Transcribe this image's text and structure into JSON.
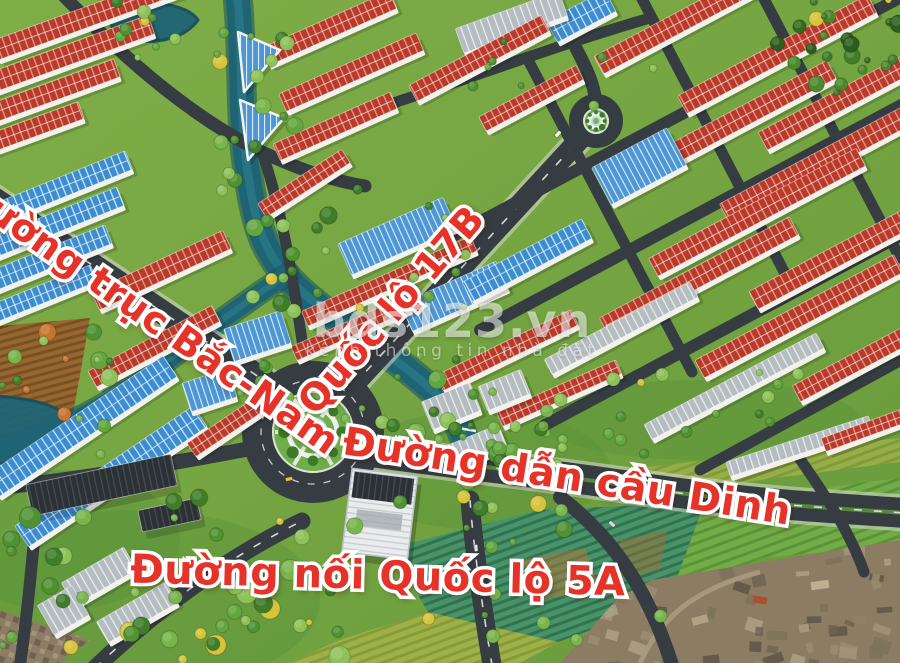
{
  "watermark": {
    "brand": "bds123.vn",
    "tagline": "kênh thông tin nhà đất"
  },
  "labels": [
    {
      "id": "bac-nam",
      "text": "Đường trục Bắc-Nam"
    },
    {
      "id": "quoc-lo-17b",
      "text": "Quốc lộ 17B"
    },
    {
      "id": "dan-cau-dinh",
      "text": "Đường dẫn cầu Dinh"
    },
    {
      "id": "noi-quoc-lo-5a",
      "text": "Đường nối Quốc lộ 5A"
    }
  ],
  "palette": {
    "label_red": "#e6332a",
    "label_outline": "#ffffff",
    "road": "#363d42",
    "red_roof": "#b93a2a",
    "blue_roof": "#3d8cd0",
    "water": "#1f6475",
    "grass": "#76a33f"
  },
  "scene": {
    "fields": [
      {
        "pts": "0,326 90,318 72,420 0,446",
        "fill": "url(#pBrown)",
        "o": 1
      },
      {
        "pts": "390,548 540,510 705,502 668,602 558,642 428,612",
        "fill": "url(#pFieldT)",
        "o": 1
      },
      {
        "pts": "705,502 900,478 900,545 762,558 668,602",
        "fill": "url(#pFieldG)",
        "o": 1
      },
      {
        "pts": "428,612 558,642 520,663 288,663 340,640",
        "fill": "url(#pFieldY)",
        "o": 0.9
      },
      {
        "pts": "640,468 900,438 900,462 652,494",
        "fill": "url(#pFieldY)",
        "o": 0.75
      },
      {
        "pts": "520,560 585,548 600,590 540,600",
        "fill": "#b5763a",
        "o": 0.5
      },
      {
        "pts": "620,540 668,530 660,570 618,578",
        "fill": "#a86c34",
        "o": 0.45
      },
      {
        "pts": "0,610 90,640 60,663 0,663",
        "fill": "url(#pPhotoM)",
        "o": 1
      }
    ],
    "photo": {
      "poly": "560,663 618,598 652,580 762,562 900,540 900,663"
    },
    "river": {
      "main": "M 237 -8 C 244 55 238 115 249 180 C 256 228 266 254 290 280 C 328 320 392 352 434 392 C 450 407 458 420 464 438",
      "fork": "M 288 274 C 248 300 208 330 168 360 C 130 390 96 412 56 428 C 36 436 12 446 -8 450",
      "wMain": 24,
      "wFork": 18
    },
    "ponds": [
      "M 112 -6 C 150 4 186 2 198 20 C 184 40 150 46 126 38 C 108 32 104 10 112 -6 Z",
      "M -5 396 C 30 398 62 404 80 428 C 64 452 30 460 -5 464 Z"
    ],
    "roads": [
      {
        "d": "M -15 193 L 296 402",
        "w": 24,
        "cas": 1,
        "dash": 1
      },
      {
        "d": "M 312 430 L 592 126",
        "w": 21,
        "cas": 1,
        "dash": 1
      },
      {
        "d": "M 596 118 C 600 72 566 44 552 -8",
        "w": 13,
        "cas": 0,
        "dash": 0
      },
      {
        "d": "M 318 444 C 430 462 540 472 650 489 C 770 506 835 508 905 513",
        "w": 30,
        "cas": 1,
        "dash": 1,
        "med": 1
      },
      {
        "d": "M 470 500 C 473 542 480 592 492 665",
        "w": 19,
        "cas": 0,
        "dash": 1
      },
      {
        "d": "M 560 497 C 606 532 646 582 672 665",
        "w": 14,
        "cas": 0,
        "dash": 0
      },
      {
        "d": "M 795 452 C 826 496 850 532 864 572",
        "w": 11,
        "cas": 0,
        "dash": 0
      },
      {
        "d": "M 258 447 C 180 462 90 478 -5 488",
        "w": 15,
        "cas": 0,
        "dash": 0
      },
      {
        "d": "M 95 668 C 152 614 222 560 302 521",
        "w": 17,
        "cas": 0,
        "dash": 1
      },
      {
        "d": "M 38 500 C 32 560 28 610 20 665",
        "w": 12,
        "cas": 0,
        "dash": 0
      },
      {
        "d": "M 62 -6 C 112 46 182 112 262 152 C 305 172 335 181 365 186",
        "w": 13,
        "cas": 0,
        "dash": 0
      },
      {
        "d": "M 262 152 C 286 222 296 300 306 368",
        "w": 11,
        "cas": 0,
        "dash": 0
      },
      {
        "d": "M 340 120 C 452 86 552 46 650 18",
        "w": 11,
        "cas": 0,
        "dash": 0
      },
      {
        "d": "M 455 235 L 905 -5",
        "w": 12,
        "cas": 0,
        "dash": 0
      },
      {
        "d": "M 480 330 L 905 103",
        "w": 12,
        "cas": 0,
        "dash": 0
      },
      {
        "d": "M 545 425 L 905 233",
        "w": 12,
        "cas": 0,
        "dash": 0
      },
      {
        "d": "M 700 470 L 905 358",
        "w": 11,
        "cas": 0,
        "dash": 0
      },
      {
        "d": "M 640 -5 L 792 287",
        "w": 11,
        "cas": 0,
        "dash": 0
      },
      {
        "d": "M 762 -5 L 900 258",
        "w": 11,
        "cas": 0,
        "dash": 0
      },
      {
        "d": "M 527 58 L 692 372",
        "w": 11,
        "cas": 0,
        "dash": 0
      }
    ],
    "roundabouts": [
      {
        "x": 313,
        "y": 432,
        "ringR": 56,
        "ringW": 30,
        "isleR": 40,
        "whiteR": 24,
        "coreR": 14,
        "spokes": 6,
        "dashR": 52
      },
      {
        "x": 596,
        "y": 121,
        "ringR": 20,
        "ringW": 14,
        "isleR": 12,
        "whiteR": 6.5,
        "coreR": 4,
        "spokes": 0,
        "dashR": 0
      }
    ],
    "rows": [
      [
        90,
        18,
        200,
        20,
        -20,
        "r"
      ],
      [
        65,
        58,
        185,
        20,
        -20,
        "r"
      ],
      [
        40,
        98,
        165,
        19,
        -20,
        "r"
      ],
      [
        16,
        136,
        140,
        18,
        -20,
        "r"
      ],
      [
        330,
        30,
        140,
        19,
        -24,
        "r"
      ],
      [
        352,
        74,
        150,
        19,
        -24,
        "r"
      ],
      [
        336,
        128,
        128,
        18,
        -24,
        "r"
      ],
      [
        305,
        185,
        100,
        16,
        -33,
        "r"
      ],
      [
        60,
        190,
        150,
        20,
        -22,
        "b"
      ],
      [
        47,
        228,
        160,
        20,
        -22,
        "b"
      ],
      [
        35,
        266,
        160,
        20,
        -22,
        "b"
      ],
      [
        25,
        303,
        150,
        18,
        -22,
        "b"
      ],
      [
        162,
        272,
        145,
        20,
        -25,
        "r"
      ],
      [
        155,
        348,
        140,
        18,
        -28,
        "r"
      ],
      [
        82,
        428,
        215,
        25,
        -34,
        "b"
      ],
      [
        112,
        478,
        215,
        25,
        -34,
        "b"
      ],
      [
        232,
        425,
        95,
        16,
        -34,
        "r"
      ],
      [
        398,
        238,
        115,
        34,
        -24,
        "g"
      ],
      [
        455,
        298,
        105,
        30,
        -24,
        "g"
      ],
      [
        390,
        283,
        185,
        16,
        -24,
        "r"
      ],
      [
        352,
        330,
        125,
        15,
        -24,
        "r"
      ],
      [
        508,
        352,
        150,
        17,
        -26,
        "r"
      ],
      [
        560,
        395,
        130,
        15,
        -24,
        "r"
      ],
      [
        688,
        20,
        200,
        20,
        -28,
        "r"
      ],
      [
        778,
        56,
        215,
        20,
        -28,
        "r"
      ],
      [
        852,
        96,
        200,
        20,
        -28,
        "r"
      ],
      [
        733,
        124,
        225,
        20,
        -28,
        "r"
      ],
      [
        820,
        164,
        215,
        20,
        -28,
        "r"
      ],
      [
        758,
        214,
        235,
        20,
        -28,
        "r"
      ],
      [
        845,
        254,
        205,
        20,
        -28,
        "r"
      ],
      [
        700,
        278,
        215,
        20,
        -28,
        "r"
      ],
      [
        800,
        318,
        225,
        20,
        -28,
        "r"
      ],
      [
        868,
        358,
        160,
        18,
        -28,
        "r"
      ],
      [
        640,
        168,
        85,
        42,
        -28,
        "g"
      ],
      [
        528,
        262,
        135,
        22,
        -28,
        "b"
      ],
      [
        582,
        18,
        66,
        24,
        -28,
        "b"
      ],
      [
        512,
        24,
        110,
        26,
        -20,
        "w"
      ],
      [
        622,
        330,
        165,
        17,
        -28,
        "w"
      ],
      [
        735,
        388,
        195,
        17,
        -28,
        "w"
      ],
      [
        800,
        448,
        150,
        15,
        -18,
        "w"
      ],
      [
        876,
        428,
        110,
        14,
        -20,
        "r"
      ],
      [
        480,
        60,
        150,
        18,
        -28,
        "r"
      ],
      [
        532,
        100,
        110,
        16,
        -28,
        "r"
      ],
      [
        452,
        408,
        52,
        30,
        -22,
        "w"
      ],
      [
        505,
        392,
        46,
        26,
        -22,
        "w"
      ],
      [
        478,
        448,
        55,
        24,
        -22,
        "w"
      ],
      [
        258,
        338,
        60,
        34,
        -18,
        "g"
      ],
      [
        210,
        392,
        48,
        30,
        -18,
        "g"
      ],
      [
        100,
        578,
        72,
        26,
        -30,
        "w"
      ],
      [
        138,
        614,
        80,
        24,
        -30,
        "w"
      ],
      [
        64,
        612,
        40,
        34,
        -30,
        "w"
      ],
      [
        102,
        487,
        148,
        32,
        -12,
        "d"
      ],
      [
        170,
        517,
        60,
        22,
        -12,
        "d"
      ]
    ],
    "tris": [
      [
        238,
        32,
        280,
        50,
        244,
        92
      ],
      [
        240,
        100,
        284,
        118,
        248,
        160
      ]
    ],
    "bigwhite": {
      "x": 347,
      "y": 472,
      "w": 66,
      "h": 84,
      "rot": 7,
      "cx": 380,
      "cy": 512
    },
    "bridge": [
      "M 434 424 L 476 431",
      "M 438 446 L 480 453"
    ],
    "villageRoad": "M 640 663 C 660 620 690 590 760 572",
    "photoRoofs": [
      [
        700,
        620,
        16,
        8,
        -15,
        "#b3a183"
      ],
      [
        760,
        600,
        14,
        7,
        10,
        "#a8512f"
      ],
      [
        820,
        585,
        18,
        8,
        -8,
        "#c0b092"
      ],
      [
        860,
        620,
        15,
        7,
        5,
        "#8f8068"
      ]
    ],
    "treeZones": [
      [
        215,
        30,
        295,
        200,
        16,
        "g",
        9
      ],
      [
        252,
        198,
        345,
        332,
        14,
        "g",
        9
      ],
      [
        332,
        352,
        572,
        532,
        40,
        "g",
        10
      ],
      [
        0,
        495,
        345,
        660,
        46,
        "g",
        11
      ],
      [
        772,
        0,
        900,
        95,
        24,
        "dark",
        9
      ],
      [
        340,
        424,
        645,
        465,
        13,
        "g",
        7
      ],
      [
        0,
        330,
        118,
        470,
        16,
        "mixed",
        9
      ],
      [
        88,
        0,
        228,
        60,
        10,
        "g",
        7
      ],
      [
        238,
        350,
        302,
        404,
        6,
        "g",
        7
      ],
      [
        320,
        180,
        470,
        335,
        10,
        "g",
        6
      ],
      [
        600,
        358,
        900,
        432,
        12,
        "g",
        7
      ],
      [
        428,
        518,
        662,
        640,
        9,
        "g",
        7
      ],
      [
        438,
        40,
        660,
        122,
        8,
        "g",
        5.5
      ]
    ],
    "cars": [
      [
        352,
        450,
        9,
        "#f4f4f4"
      ],
      [
        402,
        456,
        9,
        "#e7c62f"
      ],
      [
        558,
        134,
        -47,
        "#f4f4f4"
      ],
      [
        476,
        548,
        86,
        "#e2e2e2"
      ],
      [
        612,
        524,
        42,
        "#dadada"
      ],
      [
        289,
        479,
        -12,
        "#e7c62f"
      ],
      [
        650,
        491,
        9,
        "#f4f4f4"
      ]
    ]
  }
}
